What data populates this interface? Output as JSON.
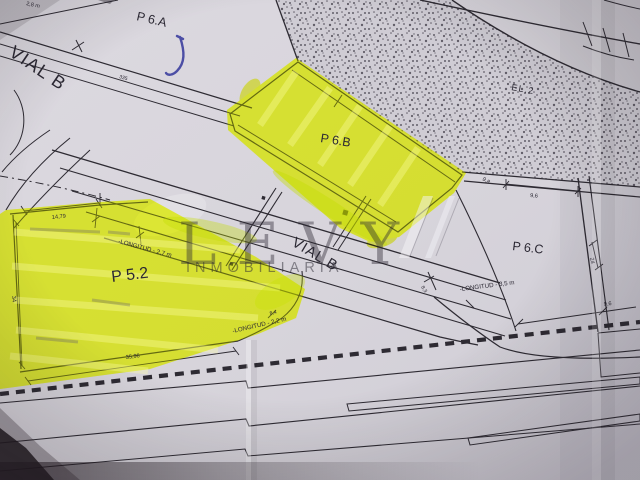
{
  "watermark": {
    "brand": "LEVY",
    "subtitle": "INMOBILIARIA"
  },
  "parcels": {
    "p6a": "P 6.A",
    "p6b": "P 6.B",
    "p6c": "P 6.C",
    "p52": "P 5.2",
    "el2": "EL.2"
  },
  "roads": {
    "vial_b_upper": "VIAL B",
    "vial_b_middle": "VIAL B"
  },
  "notes": {
    "longitud_27": "-LONGITUD - 2,7 m",
    "longitud_22": "-LONGITUD - 2,2 m",
    "longitud_35": "-LONGITUD - 3,5 m"
  },
  "dimensions": {
    "p52_top": "14,79",
    "p52_bottom": "35,96",
    "p52_left": "34",
    "p6c_top": "9,6",
    "bottom_road": "9,6",
    "stipple_edge": "9,8",
    "right_road_side": "24",
    "road_station": "335",
    "tick_a": "8,3",
    "tick_b": "8,4",
    "top_edge_partial": "2,8 m"
  },
  "colors": {
    "paper": "#d7d4db",
    "ink": "#2b2833",
    "highlight": "#e9f71f",
    "pen_mark": "#3c3f9f",
    "watermark": "#6f6a78"
  }
}
